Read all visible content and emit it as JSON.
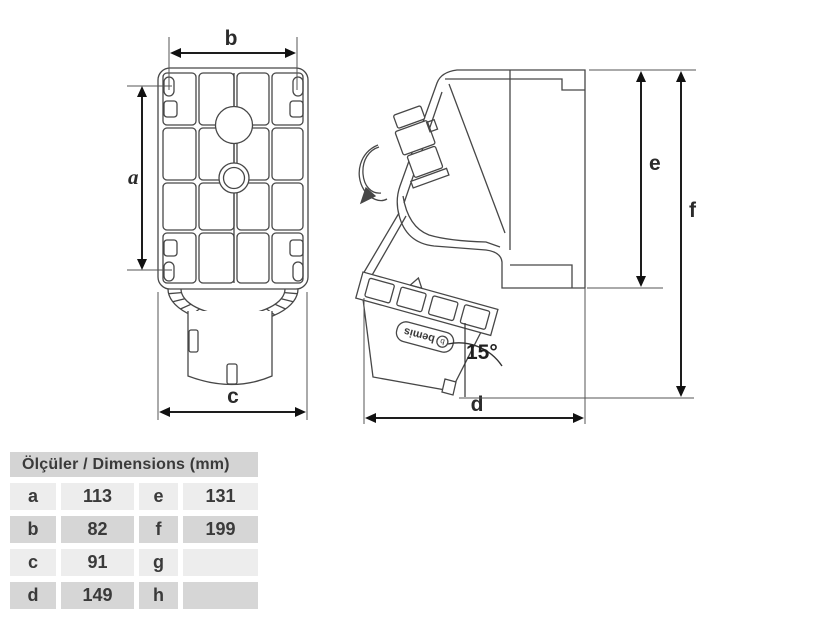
{
  "drawing": {
    "front_view": {
      "label_b": "b",
      "label_a": "a",
      "label_c": "c"
    },
    "side_view": {
      "label_d": "d",
      "label_e": "e",
      "label_f": "f",
      "angle": "15°",
      "brand": "bemis",
      "brand_logo": "b"
    },
    "colors": {
      "line": "#474747",
      "dim_line": "#1d1d1d",
      "arrow": "#111111"
    }
  },
  "table": {
    "title": "Ölçüler / Dimensions (mm)",
    "rows": [
      {
        "k1": "a",
        "v1": "113",
        "k2": "e",
        "v2": "131"
      },
      {
        "k1": "b",
        "v1": "82",
        "k2": "f",
        "v2": "199"
      },
      {
        "k1": "c",
        "v1": "91",
        "k2": "g",
        "v2": ""
      },
      {
        "k1": "d",
        "v1": "149",
        "k2": "h",
        "v2": ""
      }
    ],
    "colors": {
      "header_bg": "#d4d4d4",
      "row_light": "#ededed",
      "row_dark": "#d6d6d6",
      "text": "#3a3a3a"
    }
  }
}
